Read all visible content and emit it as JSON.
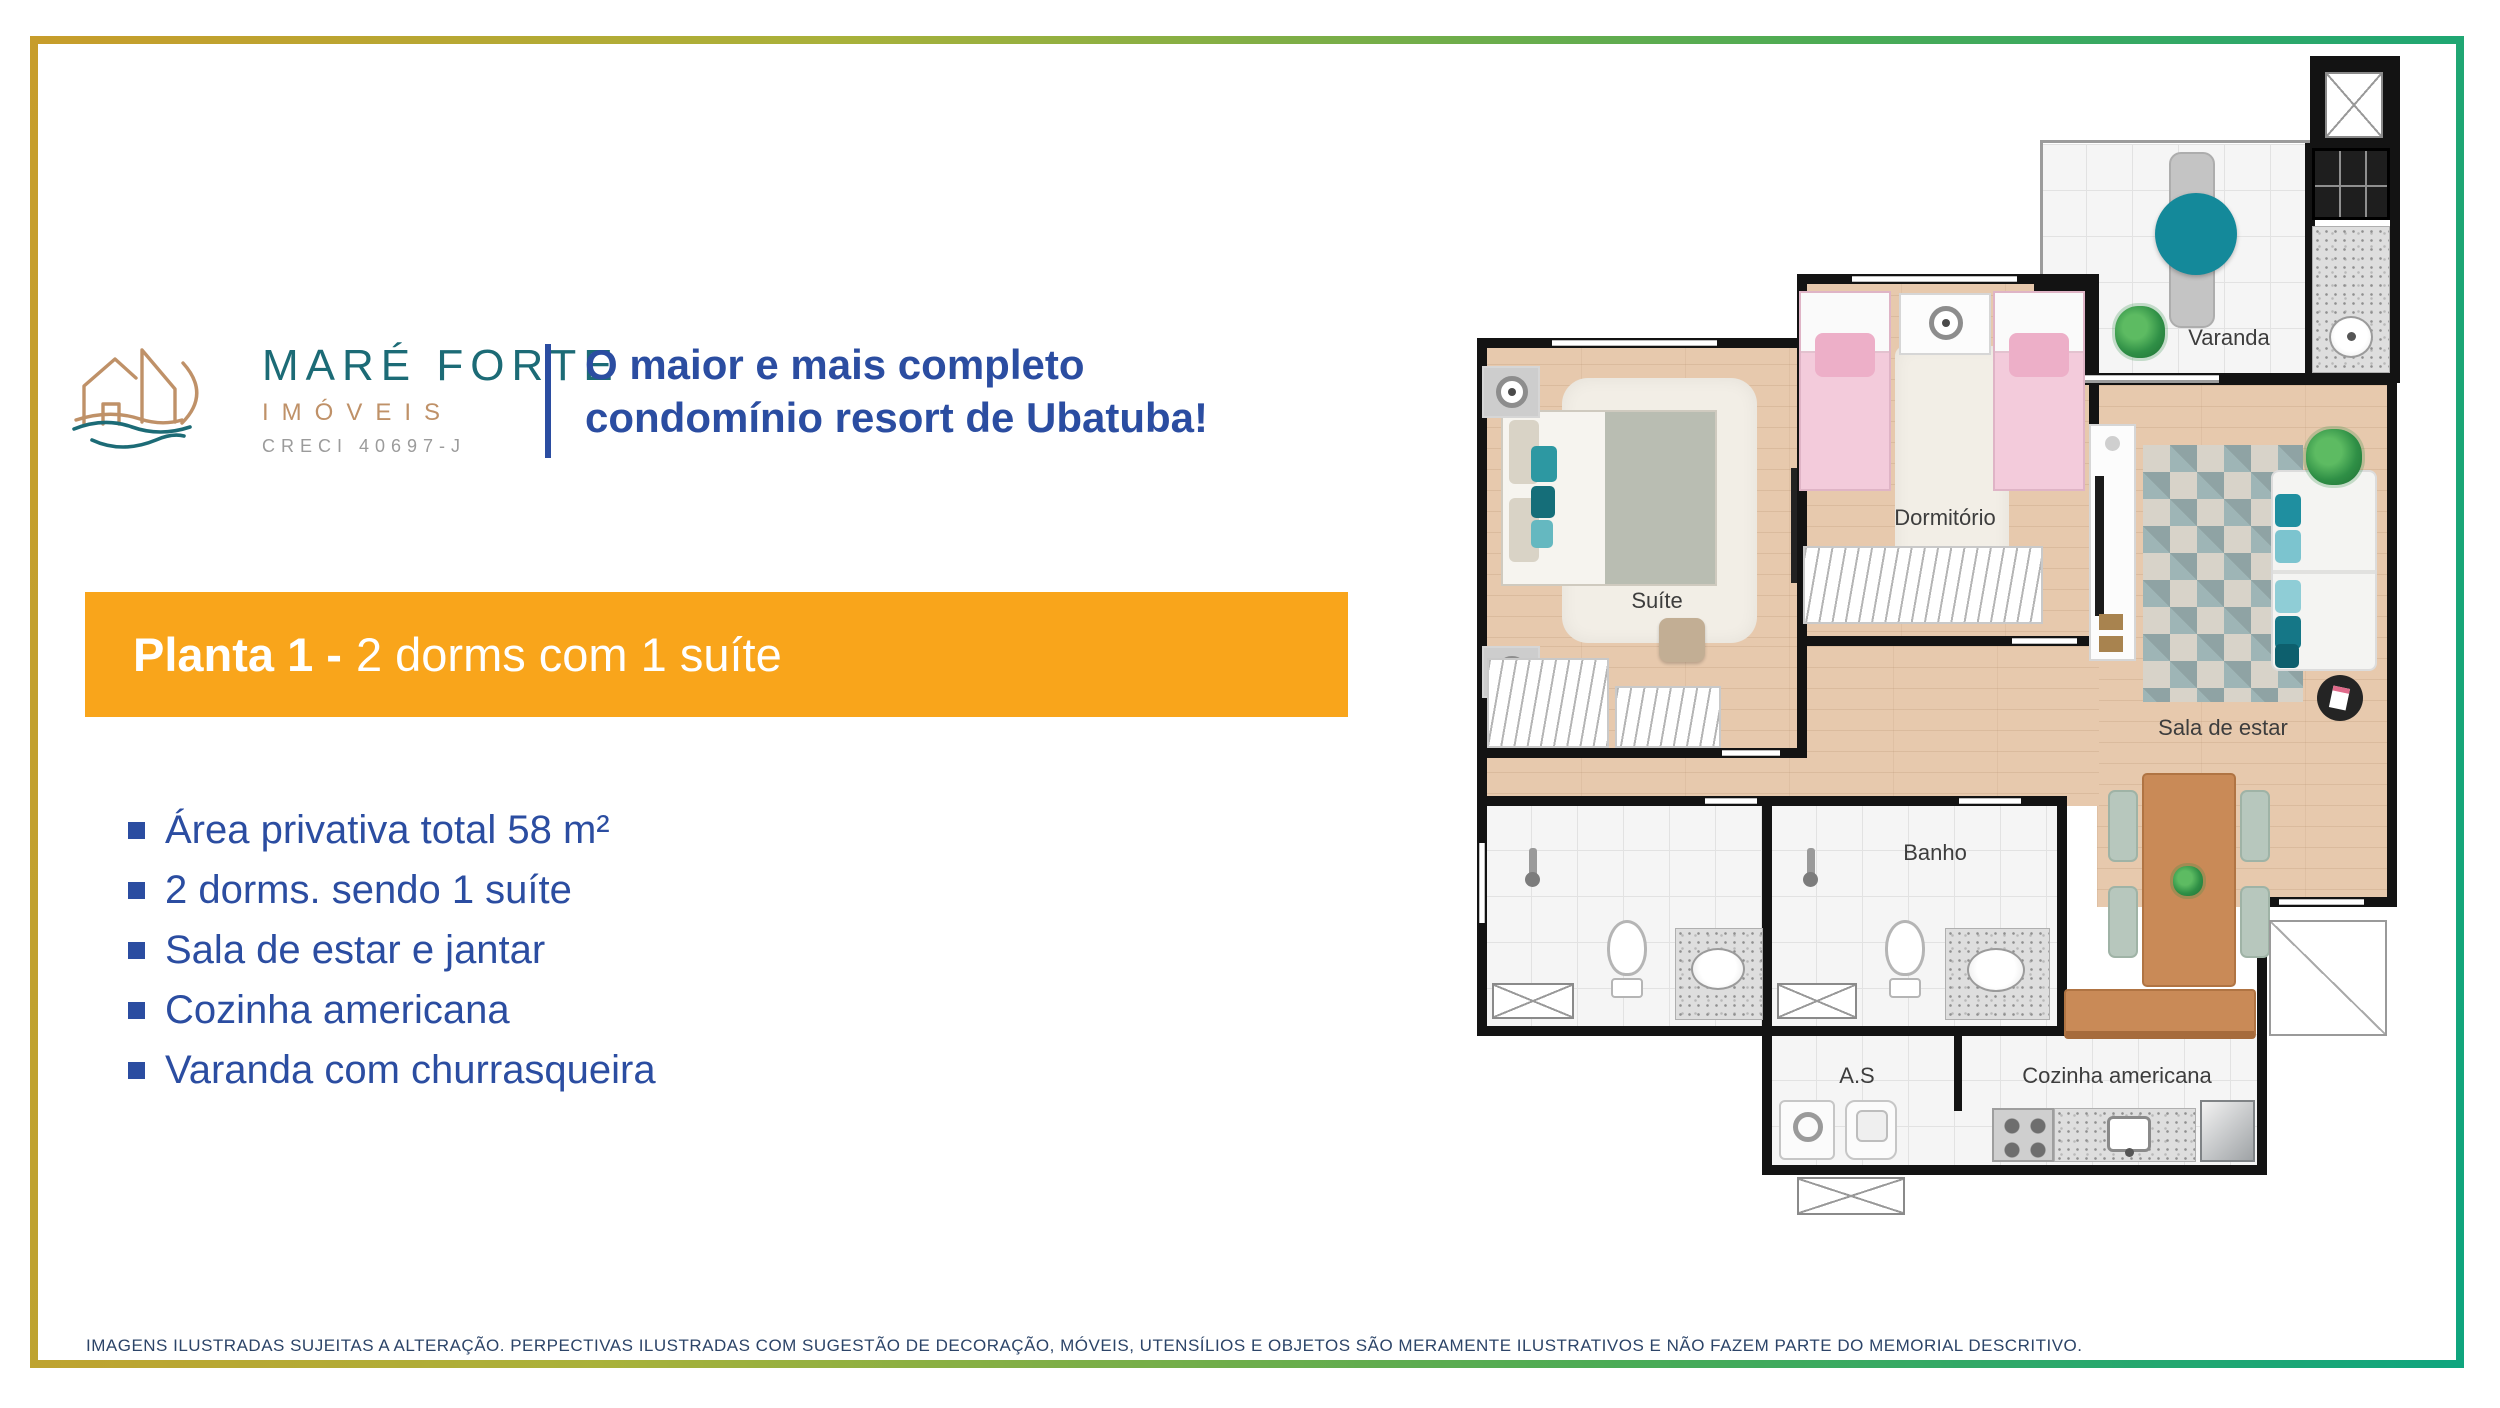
{
  "brand": {
    "name": "MARÉ FORTE",
    "subtitle": "IMÓVEIS",
    "creci": "CRECI 40697-J"
  },
  "headline": {
    "line1": "O maior e mais completo",
    "line2": "condomínio resort de Ubatuba!"
  },
  "banner": {
    "title_bold": "Planta 1 -",
    "title_regular": "2 dorms com 1 suíte"
  },
  "features": {
    "items": [
      "Área privativa total 58 m²",
      "2 dorms. sendo 1 suíte",
      "Sala de estar e jantar",
      "Cozinha americana",
      "Varanda com churrasqueira"
    ]
  },
  "floorplan": {
    "labels": {
      "varanda": "Varanda",
      "dormitorio": "Dormitório",
      "suite": "Suíte",
      "sala": "Sala de estar",
      "banho": "Banho",
      "area_servico": "A.S",
      "cozinha": "Cozinha americana"
    }
  },
  "disclaimer": "IMAGENS ILUSTRADAS SUJEITAS A ALTERAÇÃO. PERPECTIVAS ILUSTRADAS COM SUGESTÃO DE DECORAÇÃO, MÓVEIS, UTENSÍLIOS E OBJETOS SÃO MERAMENTE ILUSTRATIVOS E NÃO FAZEM PARTE DO MEMORIAL DESCRITIVO.",
  "colors": {
    "accent_orange": "#F9A51B",
    "brand_blue": "#2B4DA1",
    "brand_teal": "#1C6B76",
    "brand_tan": "#BF9168",
    "frame_gold": "#C79D2B",
    "frame_teal": "#0FA57E",
    "table_teal": "#14899A"
  }
}
